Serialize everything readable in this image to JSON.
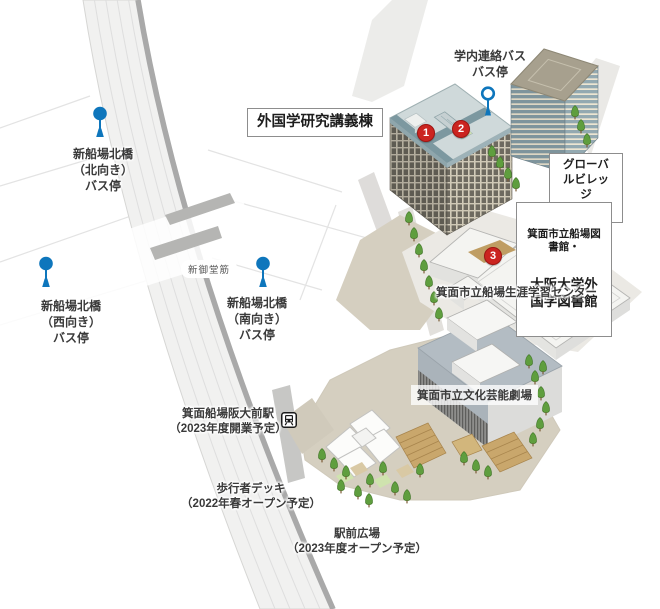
{
  "map_labels": {
    "bus_stops": {
      "north": "新船場北橋\n（北向き）\nバス停",
      "west": "新船場北橋\n（西向き）\nバス停",
      "south": "新船場北橋\n（南向き）\nバス停",
      "campus_shuttle": "学内連絡バス\nバス停"
    },
    "road": "新御堂筋",
    "buildings": {
      "lecture_hall": "外国学研究講義棟",
      "global_village": "グローバルビレッジ\n箕面船場",
      "library_line1": "箕面市立船場図書館・",
      "library_line2": "大阪大学外国学図書館",
      "learning_center": "箕面市立船場生涯学習センター",
      "theater": "箕面市立文化芸能劇場"
    },
    "station": "箕面船場阪大前駅\n（2023年度開業予定）",
    "pedestrian_deck": "歩行者デッキ\n（2022年春オープン予定）",
    "station_plaza": "駅前広場\n（2023年度オープン予定）"
  },
  "markers": [
    {
      "number": "1"
    },
    {
      "number": "2"
    },
    {
      "number": "3"
    }
  ],
  "colors": {
    "bus_pin_blue": "#0e76bc",
    "marker_red": "#cb2420",
    "road_fill": "#f1f1f0",
    "road_edge_dark": "#a9a9a9",
    "campus_ground_beige": "#d5cfc0",
    "lecture_roof_teal": "#7c98a0",
    "global_village_roof_khaki": "#a7a08e",
    "stairs_tan": "#c9a76c",
    "tree_green": "#5f9e3e"
  }
}
